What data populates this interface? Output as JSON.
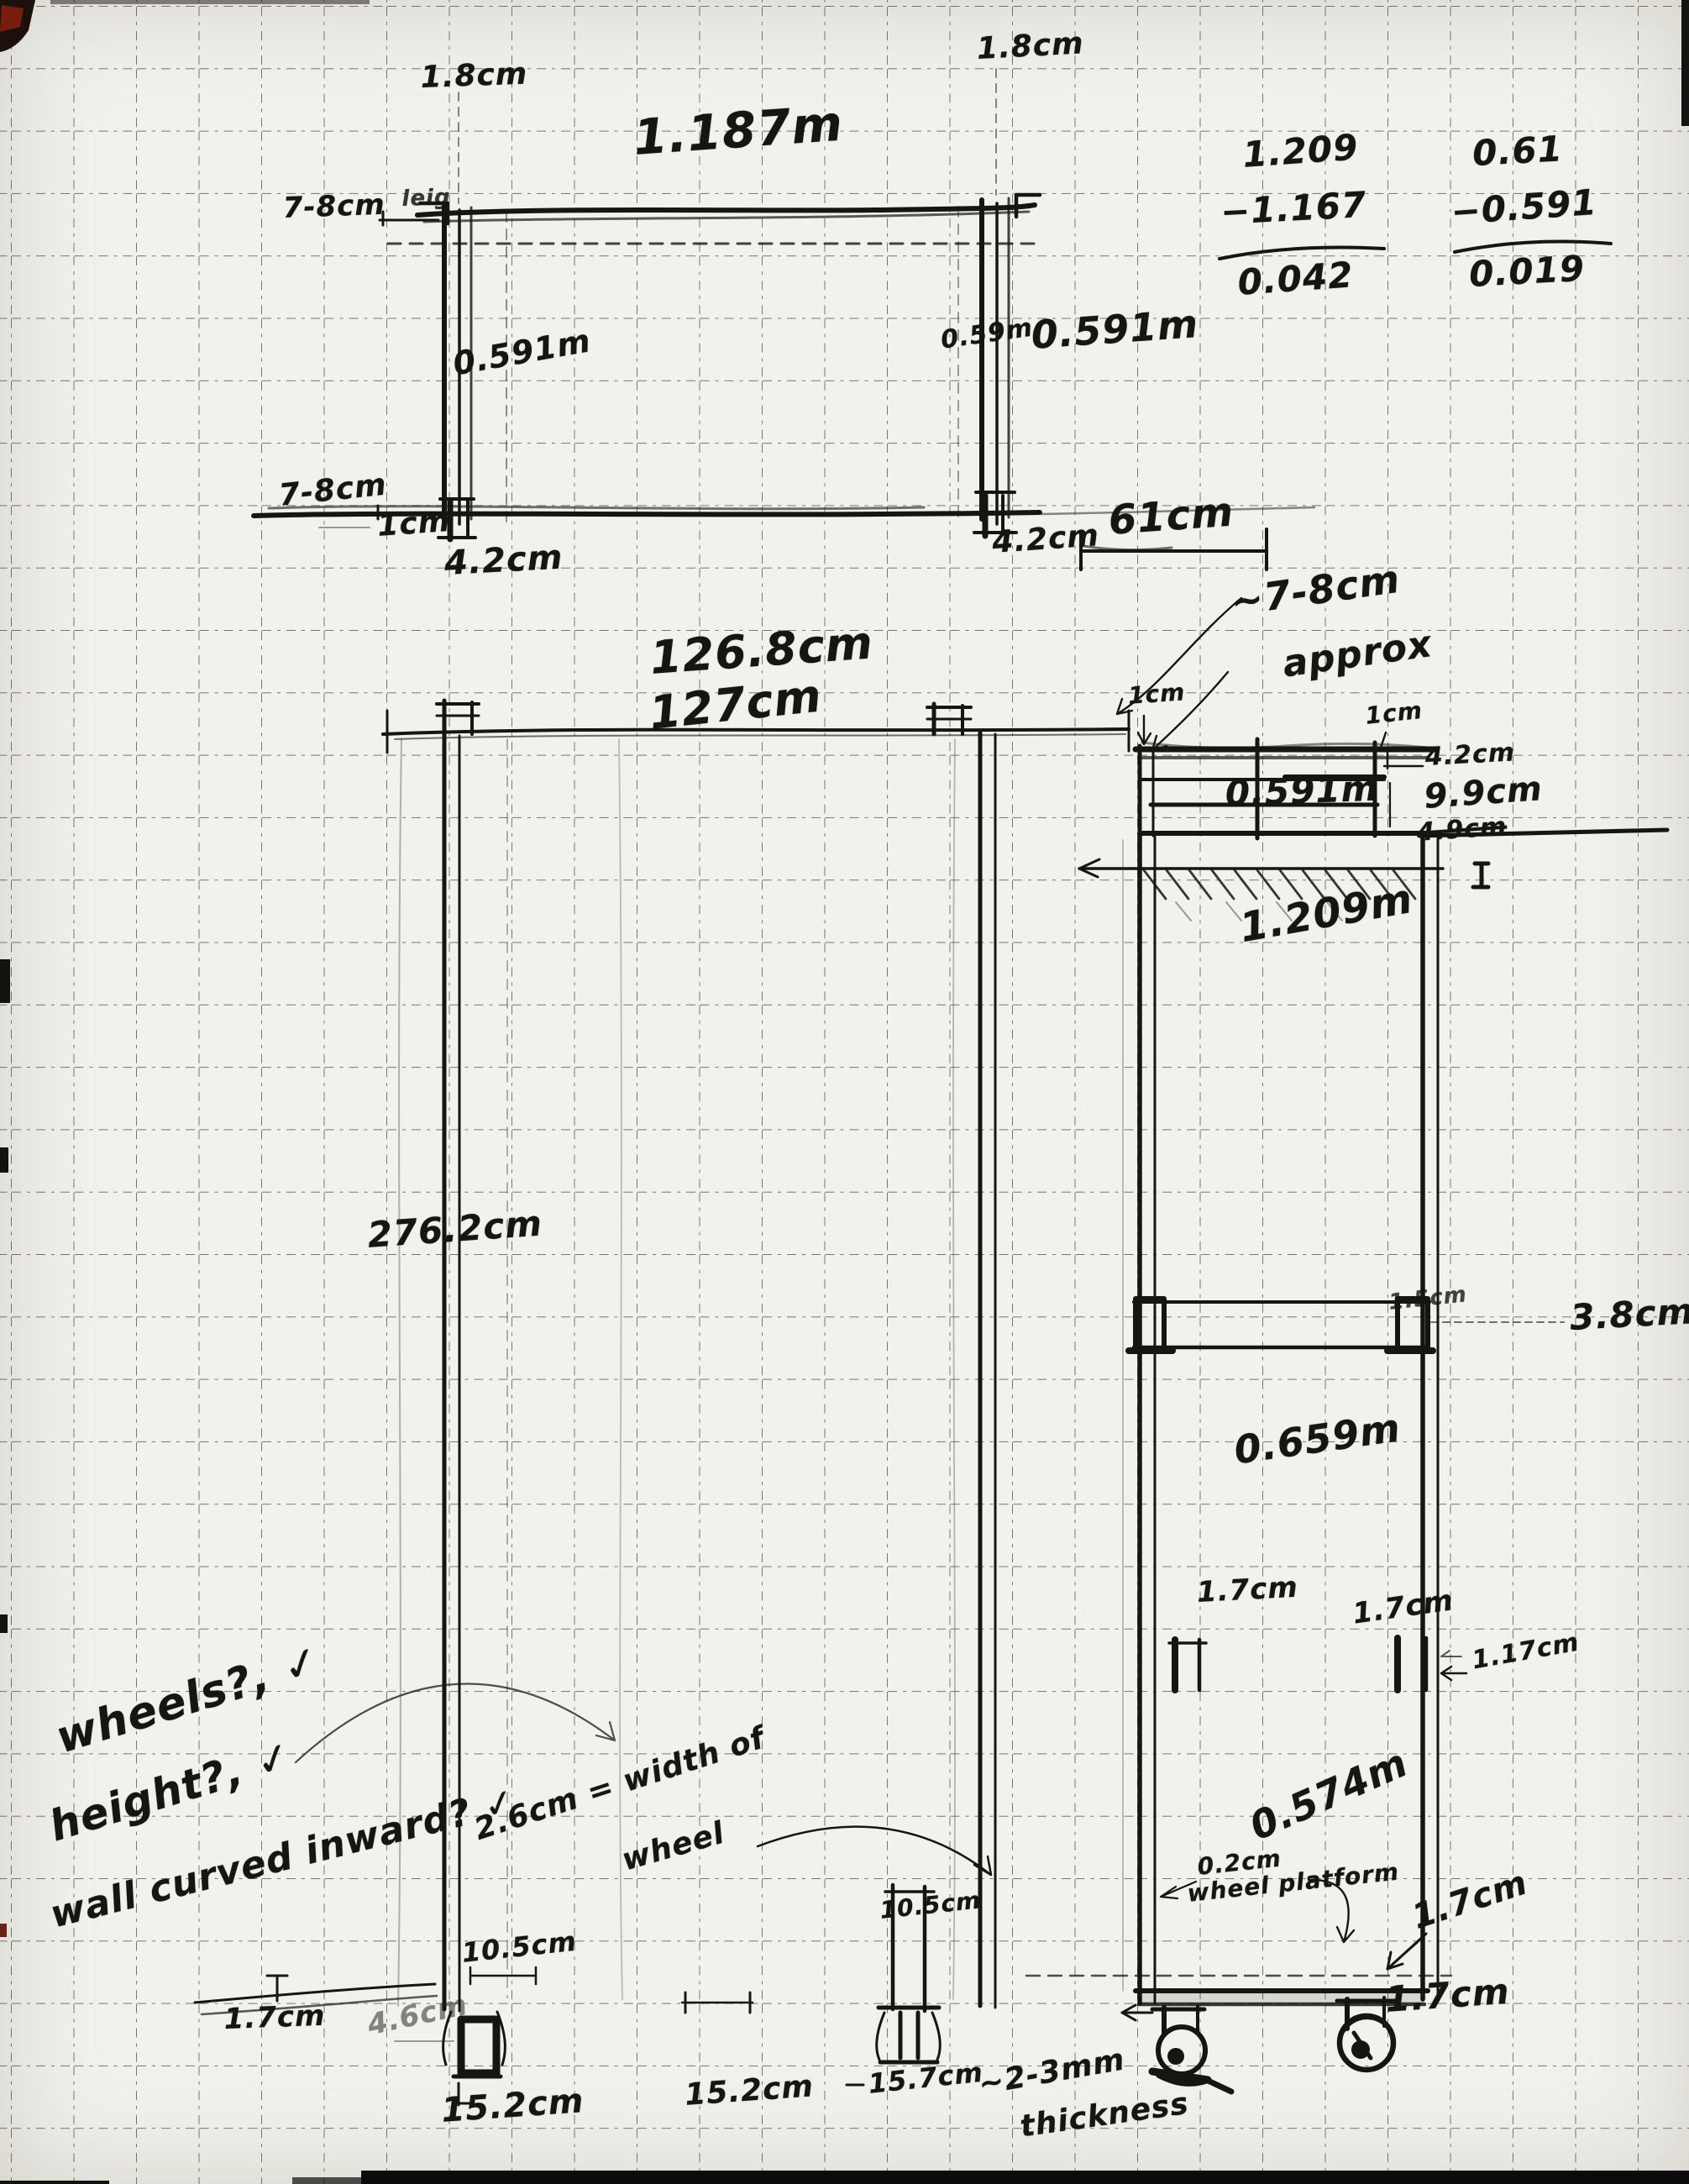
{
  "colors": {
    "ink": "#17150f",
    "paper": "#f2f1ec",
    "grid": "#4a463e"
  },
  "top_view": {
    "wall_left": "1.8cm",
    "wall_right": "1.8cm",
    "width": "1.187m",
    "leg_top": "7-8cm",
    "leg_top_scribble": "leig",
    "height_left": "0.591m",
    "height_right_small": "0.59m",
    "height_right": "0.591m",
    "leg_bottom": "7-8cm",
    "offset_bottom": "1cm",
    "foot_left": "4.2cm",
    "foot_right": "4.2cm"
  },
  "calculations": {
    "col1": {
      "minuend": "1.209",
      "subtrahend": "−1.167",
      "result": "0.042"
    },
    "col2": {
      "minuend": "0.61",
      "subtrahend": "−0.591",
      "result": "0.019"
    }
  },
  "side_view": {
    "top_width": "61cm",
    "approx_line1": "~7-8cm",
    "approx_line2": "approx",
    "span_a": "126.8cm",
    "span_b": "127cm",
    "corner_left": "1cm",
    "corner_right": "1cm",
    "box_wall": "4.2cm",
    "box_height": "9.9cm",
    "box_height_struck": "4.9cm",
    "box_width": "0.591m",
    "upper_height": "1.209m",
    "overall_height": "276.2cm",
    "brace_wall": "1.5cm",
    "brace_height": "3.8cm",
    "lower_height": "0.659m",
    "tube_left": "1.7cm",
    "tube_right": "1.7cm",
    "tube_inner": "1.17cm",
    "base_width": "0.574m",
    "platform_thickness": "0.2cm",
    "platform_label": "wheel platform",
    "platform_side": "1.7cm",
    "platform_height": "1.7cm"
  },
  "feet": {
    "left_top": "10.5cm",
    "left_side": "1.7cm",
    "left_inner": "4.6cm",
    "spacing_a": "15.2cm",
    "spacing_b": "15.2cm",
    "mid_top": "10.5cm",
    "mid_spacing": "15.7cm",
    "thickness_line1": "~2-3mm",
    "thickness_line2": "thickness"
  },
  "notes": {
    "wheels": "wheels?, ✓",
    "height": "height?, ✓",
    "wall": "wall curved inward? ✓",
    "wheel_width_line1": "2.6cm = width of",
    "wheel_width_line2": "wheel"
  }
}
